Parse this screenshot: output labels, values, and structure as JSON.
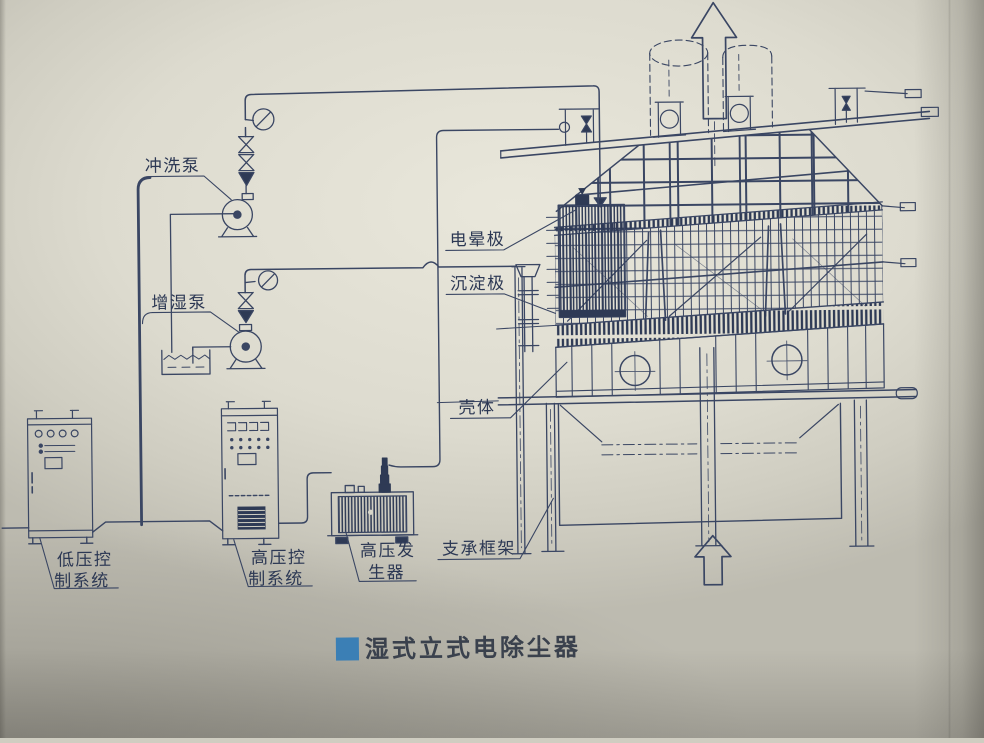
{
  "colors": {
    "ink": "#3a4663",
    "ink_dark": "#2e3a55",
    "paper": "#d8d6ca",
    "caption_marker": "#3b7fb5",
    "caption_text": "#3a414d"
  },
  "labels": {
    "flush_pump": "冲洗泵",
    "humidify_pump": "增湿泵",
    "corona_electrode": "电晕极",
    "collecting_electrode": "沉淀极",
    "shell": "壳体",
    "support_frame": "支承框架",
    "lv_control_line1": "低压控",
    "lv_control_line2": "制系统",
    "hv_control_line1": "高压控",
    "hv_control_line2": "制系统",
    "hv_generator_line1": "高压发",
    "hv_generator_line2": "生器"
  },
  "caption": {
    "text": "湿式立式电除尘器"
  }
}
